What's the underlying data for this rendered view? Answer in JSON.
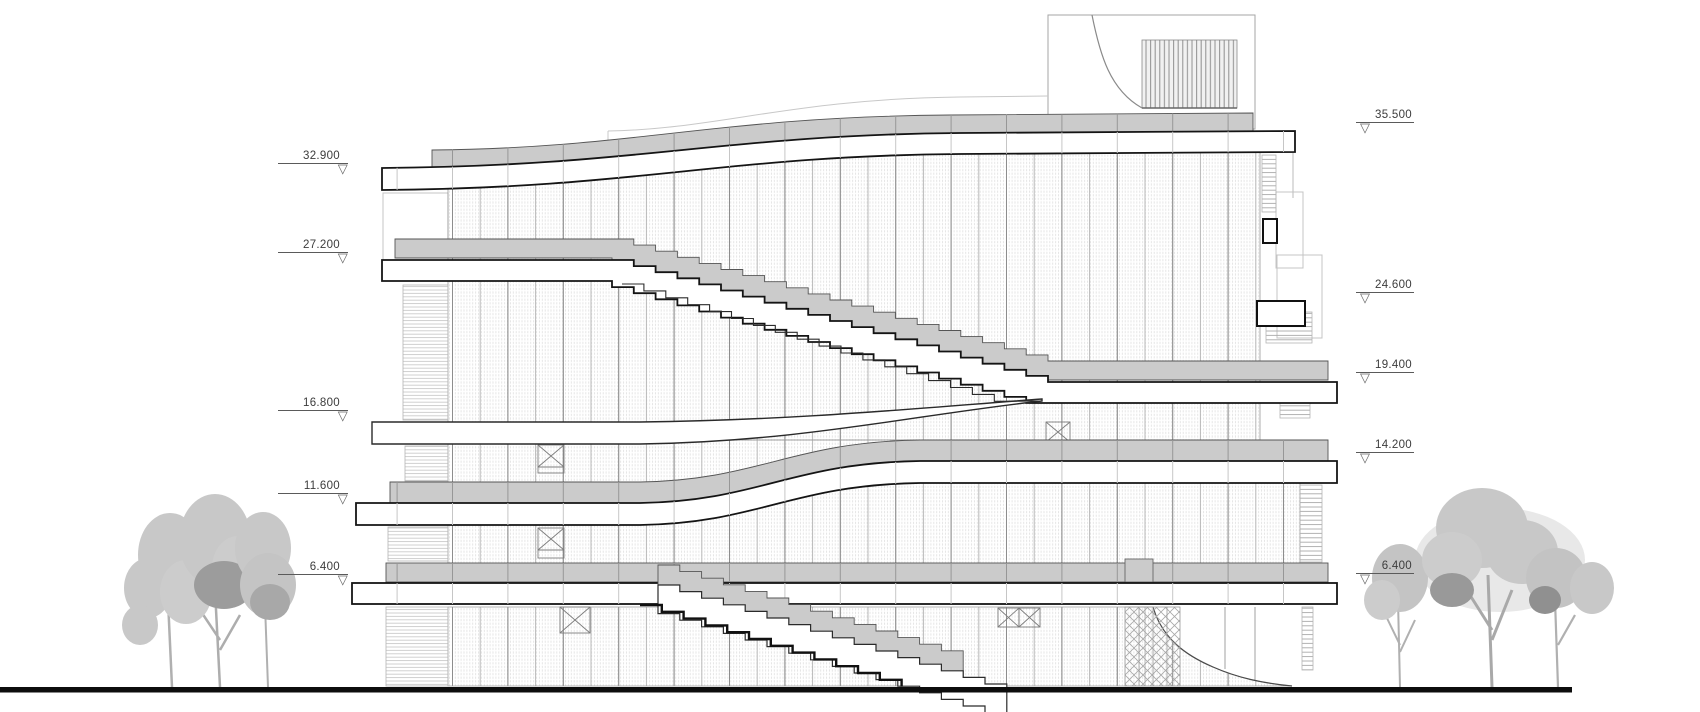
{
  "drawing": {
    "kind": "architectural elevation",
    "marker_glyph": "▽",
    "left_levels": [
      {
        "value": "32.900"
      },
      {
        "value": "27.200"
      },
      {
        "value": "16.800"
      },
      {
        "value": "11.600"
      },
      {
        "value": "6.400"
      }
    ],
    "right_levels": [
      {
        "value": "35.500"
      },
      {
        "value": "24.600"
      },
      {
        "value": "19.400"
      },
      {
        "value": "14.200"
      },
      {
        "value": "6.400"
      }
    ],
    "colors": {
      "line": "#1a1a1a",
      "slab_fill": "#ffffff",
      "band_fill": "#cbcbcb",
      "hatch_line": "#dfdfdf",
      "tree_light": "#c8c8c8",
      "tree_dark": "#9c9c9c",
      "ground_line": "#0d0d0d",
      "label_text": "#3c3c3c"
    }
  }
}
